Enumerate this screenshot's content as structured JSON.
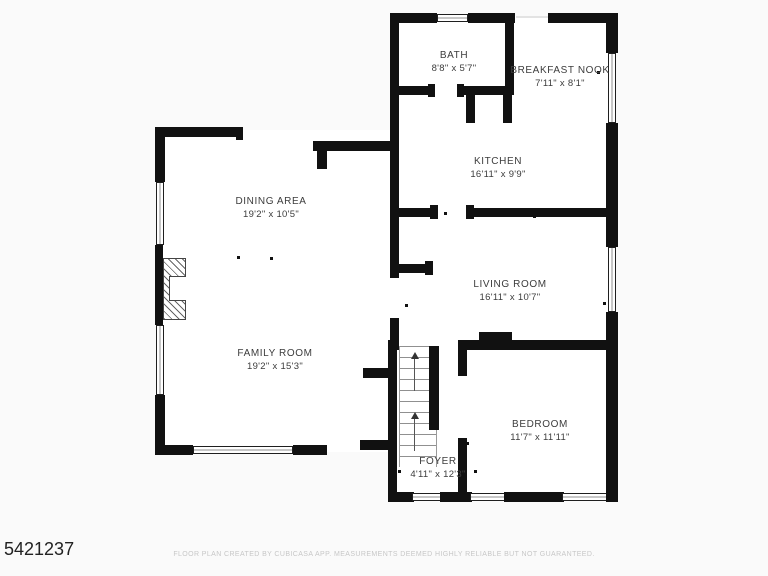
{
  "plan": {
    "id": "5421237",
    "footer": "FLOOR PLAN CREATED BY CUBICASA APP. MEASUREMENTS DEEMED HIGHLY RELIABLE BUT NOT GUARANTEED.",
    "rooms": [
      {
        "name": "BATH",
        "dims": "8'8\" x 5'7\""
      },
      {
        "name": "BREAKFAST NOOK",
        "dims": "7'11\" x 8'1\""
      },
      {
        "name": "KITCHEN",
        "dims": "16'11\" x 9'9\""
      },
      {
        "name": "DINING AREA",
        "dims": "19'2\" x 10'5\""
      },
      {
        "name": "LIVING ROOM",
        "dims": "16'11\" x 10'7\""
      },
      {
        "name": "FAMILY ROOM",
        "dims": "19'2\" x 15'3\""
      },
      {
        "name": "BEDROOM",
        "dims": "11'7\" x 11'11\""
      },
      {
        "name": "FOYER",
        "dims": "4'11\" x 12'3\""
      }
    ],
    "colors": {
      "wall": "#111111",
      "room_fill": "#ffffff",
      "background": "#fafafa",
      "label_text": "#3c3c3c",
      "footer_text": "#c7c7c7"
    }
  }
}
